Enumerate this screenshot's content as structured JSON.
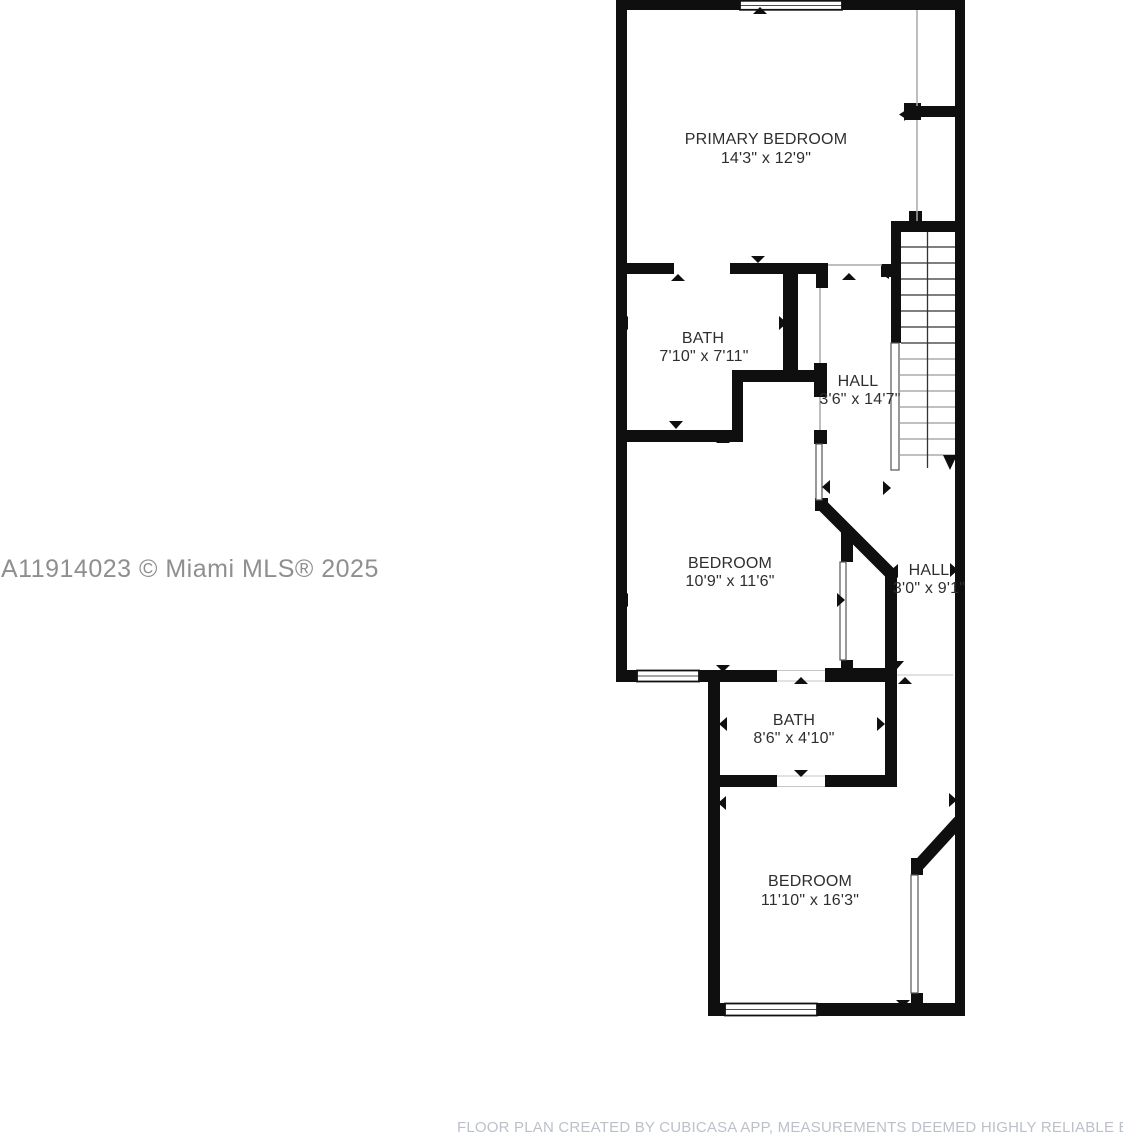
{
  "floor_plan": {
    "rooms": [
      {
        "name": "PRIMARY BEDROOM",
        "dimensions": "14'3\" x 12'9\""
      },
      {
        "name": "BATH",
        "dimensions": "7'10\" x 7'11\""
      },
      {
        "name": "HALL",
        "dimensions": "3'6\" x 14'7\""
      },
      {
        "name": "BEDROOM",
        "dimensions": "10'9\" x 11'6\""
      },
      {
        "name": "HALL",
        "dimensions": "3'0\" x 9'1\""
      },
      {
        "name": "BATH",
        "dimensions": "8'6\" x 4'10\""
      },
      {
        "name": "BEDROOM",
        "dimensions": "11'10\" x 16'3\""
      }
    ],
    "stairs": {
      "direction": "down"
    },
    "window_count": 3,
    "colors": {
      "wall": "#0f0f0f",
      "label": "#2e2e2e",
      "watermark": "#8f8f8f",
      "footer": "#bcc1c9",
      "thin_line": "#a8a8a8"
    }
  },
  "watermark": {
    "text": "A11914023 © Miami MLS® 2025"
  },
  "footer": {
    "text": "FLOOR PLAN CREATED BY CUBICASA APP, MEASUREMENTS DEEMED HIGHLY RELIABLE BUT NOT GUARANTEED"
  }
}
